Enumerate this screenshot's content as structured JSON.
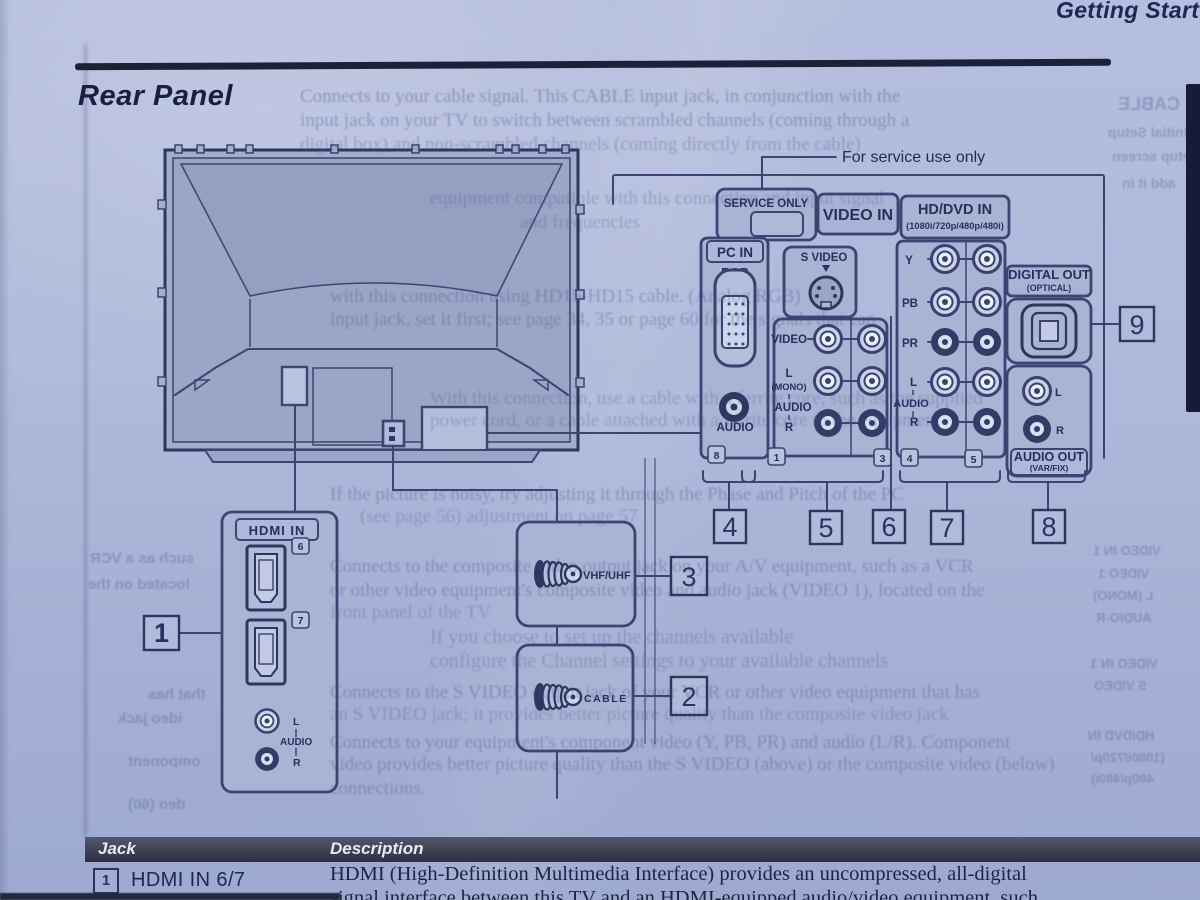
{
  "page": {
    "chapter_header": "Getting Started",
    "section_title": "Rear Panel"
  },
  "diagram": {
    "service_note": "For service use only",
    "labels": {
      "service_only": "SERVICE ONLY",
      "video_in": "VIDEO IN",
      "hddvd_in": "HD/DVD IN",
      "hddvd_formats": "(1080i/720p/480p/480i)",
      "pc_in": "PC IN",
      "rgb": "RGB",
      "audio": "AUDIO",
      "s_video": "S VIDEO",
      "video": "VIDEO",
      "l": "L",
      "mono": "(MONO)",
      "r": "R",
      "y": "Y",
      "pb": "PB",
      "pr": "PR",
      "digital_out": "DIGITAL OUT",
      "optical": "(OPTICAL)",
      "audio_out": "AUDIO OUT",
      "var_fix": "(VAR/FIX)",
      "hdmi_in": "HDMI IN",
      "vhf_uhf": "VHF/UHF",
      "cable": "CABLE"
    },
    "jack_tags": {
      "pc": "8",
      "video1": "1",
      "video3": "3",
      "hd4": "4",
      "hd5": "5",
      "hdmi6": "6",
      "hdmi7": "7"
    },
    "callouts": {
      "c1": "1",
      "c2": "2",
      "c3": "3",
      "c4": "4",
      "c5": "5",
      "c6": "6",
      "c7": "7",
      "c8": "8",
      "c9": "9"
    }
  },
  "table": {
    "headers": [
      "Jack",
      "Description"
    ],
    "rows": [
      {
        "num": "1",
        "jack": "HDMI IN 6/7",
        "desc_line1": "HDMI (High-Definition Multimedia Interface) provides an uncompressed, all-digital",
        "desc_line2": "signal interface between this TV and an HDMI-equipped audio/video equipment, such"
      }
    ]
  },
  "ghost": {
    "lines": [
      {
        "x": 300,
        "y": 86,
        "s": 19,
        "t": "Connects to your cable signal. This CABLE input jack, in conjunction with the",
        "o": 0.38
      },
      {
        "x": 300,
        "y": 110,
        "s": 19,
        "t": "input jack on your TV to switch between scrambled channels (coming through a",
        "o": 0.36
      },
      {
        "x": 300,
        "y": 134,
        "s": 19,
        "t": "digital box) and non-scrambled channels (coming directly from the cable)",
        "o": 0.3
      },
      {
        "x": 430,
        "y": 188,
        "s": 19,
        "t": "equipment compatible with this connection and input signal"
      },
      {
        "x": 520,
        "y": 212,
        "s": 19,
        "t": "and frequencies"
      },
      {
        "x": 330,
        "y": 286,
        "s": 19,
        "t": "with this connection using HD15-HD15 cable. (Analog RGB)",
        "o": 0.34
      },
      {
        "x": 330,
        "y": 309,
        "s": 19,
        "t": "input jack, set it first; see page 34, 35 or page 60 for the signals that can",
        "o": 0.34
      },
      {
        "x": 430,
        "y": 388,
        "s": 19,
        "t": "With this connection, use a cable with a ferrite core, such as the supplied"
      },
      {
        "x": 430,
        "y": 410,
        "s": 19,
        "t": "power cord, or a cable attached with a ferrite core to the equipment"
      },
      {
        "x": 330,
        "y": 484,
        "s": 19,
        "t": "If the picture is noisy, try adjusting it through the Phase and Pitch of the PC",
        "o": 0.34
      },
      {
        "x": 360,
        "y": 506,
        "s": 19,
        "t": "(see page 56) adjustment on page 57"
      },
      {
        "x": 330,
        "y": 556,
        "s": 19,
        "t": "Connects to the composite video output jack on your A/V equipment, such as a VCR",
        "o": 0.34
      },
      {
        "x": 330,
        "y": 580,
        "s": 19,
        "t": "or other video equipment's composite video and audio jack (VIDEO 1), located on the",
        "o": 0.34
      },
      {
        "x": 330,
        "y": 602,
        "s": 19,
        "t": "front panel of the TV"
      },
      {
        "x": 430,
        "y": 626,
        "s": 20,
        "t": "If you choose to set up the channels available"
      },
      {
        "x": 430,
        "y": 650,
        "s": 20,
        "t": "configure the Channel settings to your available channels"
      },
      {
        "x": 330,
        "y": 682,
        "s": 19,
        "t": "Connects to the S VIDEO output jack of your VCR or other video equipment that has",
        "o": 0.34
      },
      {
        "x": 330,
        "y": 704,
        "s": 19,
        "t": "an S VIDEO jack; it provides better picture quality than the composite video jack"
      },
      {
        "x": 330,
        "y": 732,
        "s": 19,
        "t": "Connects to your equipment's component video (Y, PB, PR) and audio (L/R). Component",
        "o": 0.34
      },
      {
        "x": 330,
        "y": 754,
        "s": 19,
        "t": "video provides better picture quality than the S VIDEO (above) or the composite video (below)",
        "o": 0.34
      },
      {
        "x": 330,
        "y": 778,
        "s": 19,
        "t": "connections.",
        "o": 0.34
      },
      {
        "x": 1093,
        "y": 543,
        "s": 13,
        "t": "VIDEO IN 1",
        "m": 1
      },
      {
        "x": 1098,
        "y": 566,
        "s": 13,
        "t": "VIDEO 1",
        "m": 1
      },
      {
        "x": 1093,
        "y": 588,
        "s": 13,
        "t": "L (MONO)",
        "m": 1
      },
      {
        "x": 1096,
        "y": 610,
        "s": 13,
        "t": "AUDIO-R",
        "m": 1
      },
      {
        "x": 1090,
        "y": 656,
        "s": 13,
        "t": "VIDEO IN 1",
        "m": 1
      },
      {
        "x": 1094,
        "y": 678,
        "s": 13,
        "t": "S VIDEO",
        "m": 1
      },
      {
        "x": 1088,
        "y": 728,
        "s": 13,
        "t": "HD/DVD IN",
        "m": 1
      },
      {
        "x": 1091,
        "y": 750,
        "s": 13,
        "t": "(1080i/720p/",
        "m": 1
      },
      {
        "x": 1091,
        "y": 771,
        "s": 13,
        "t": "480p/480i)",
        "m": 1
      },
      {
        "x": 1118,
        "y": 94,
        "s": 18,
        "t": "CABLE",
        "m": 1
      },
      {
        "x": 1108,
        "y": 124,
        "s": 14,
        "t": "initial Setup",
        "m": 1
      },
      {
        "x": 1112,
        "y": 148,
        "s": 14,
        "t": "Setup screen",
        "m": 1
      },
      {
        "x": 1122,
        "y": 175,
        "s": 14,
        "t": "add it in",
        "m": 1
      },
      {
        "x": 90,
        "y": 550,
        "s": 15,
        "t": "such as a VCR",
        "m": 1
      },
      {
        "x": 88,
        "y": 576,
        "s": 15,
        "t": "located on the",
        "m": 1
      },
      {
        "x": 148,
        "y": 686,
        "s": 15,
        "t": "that has",
        "m": 1
      },
      {
        "x": 118,
        "y": 710,
        "s": 15,
        "t": "ideo jack",
        "m": 1
      },
      {
        "x": 128,
        "y": 753,
        "s": 15,
        "t": "omponent",
        "m": 1
      },
      {
        "x": 128,
        "y": 796,
        "s": 15,
        "t": "deo (60)",
        "m": 1
      }
    ]
  }
}
